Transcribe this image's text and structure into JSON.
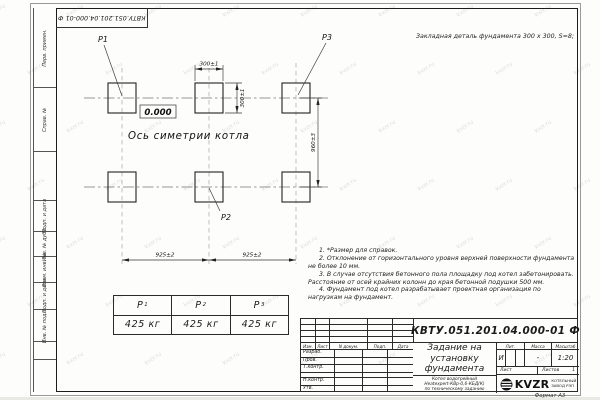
{
  "watermark": "kvzr.ru",
  "doc": {
    "number": "КВТУ.051.201.04.000-01 Ф",
    "format_label": "Формат А3"
  },
  "header_note": "Закладная деталь фундамента  300 х 300,  S=8;",
  "side_strip": {
    "items": [
      "Перв. примен.",
      "Справ. №",
      "Подп. и дата",
      "Инв. № дубл.",
      "Взам. инв. №",
      "Подп. и дата",
      "Инв. № подл."
    ]
  },
  "drawing": {
    "point_labels": {
      "p1": "Р1",
      "p2": "Р2",
      "p3": "Р3"
    },
    "elevation": "0.000",
    "axis_label": "Ось симетрии котла",
    "dims": {
      "pad_width": "300±1",
      "pad_height": "300±1",
      "row_spacing": "960±3",
      "span_left": "925±2",
      "span_right": "925±2"
    }
  },
  "loads_table": {
    "headers": [
      {
        "base": "Р",
        "sub": "1"
      },
      {
        "base": "Р",
        "sub": "2"
      },
      {
        "base": "Р",
        "sub": "3"
      }
    ],
    "values": [
      "425 кг",
      "425 кг",
      "425 кг"
    ]
  },
  "notes": [
    "1. *Размер для справок.",
    "2. Отклонение от горизонтального уровня верхней поверхности фундамента не более 10 мм.",
    "3. В случае отсутствия бетонного пола площадку под котел забетонировать. Расстояние от осей крайних колонн до края бетонной подушки 500 мм.",
    "4. Фундамент под котел разрабатывает проектная организация по нагрузкам на фундамент."
  ],
  "title_block": {
    "rev_header": [
      "Изм.",
      "Лист",
      "N докум.",
      "Подп.",
      "Дата"
    ],
    "sig_rows": [
      "Разраб.",
      "Пров.",
      "Т.контр.",
      "",
      "Н.контр.",
      "Утв."
    ],
    "title_lines": [
      "Задание на",
      "установку",
      "фундамента"
    ],
    "lit_header": [
      "Лит.",
      "Масса",
      "Масштаб"
    ],
    "lit_value": "И",
    "mass_value": "-",
    "scale_value": "1:20",
    "sheet_label": "Лист",
    "sheets_label": "Листов",
    "sheets_value": "1",
    "product_lines": [
      "Котел водогрейный",
      "Heatexpert-КВр-0,6-КБД(К)",
      "по техническому заданию"
    ],
    "logo_text": "KVZR",
    "logo_caption_lines": [
      "КОТЕЛЬНЫЙ",
      "ЗАВОД РЭП"
    ]
  }
}
